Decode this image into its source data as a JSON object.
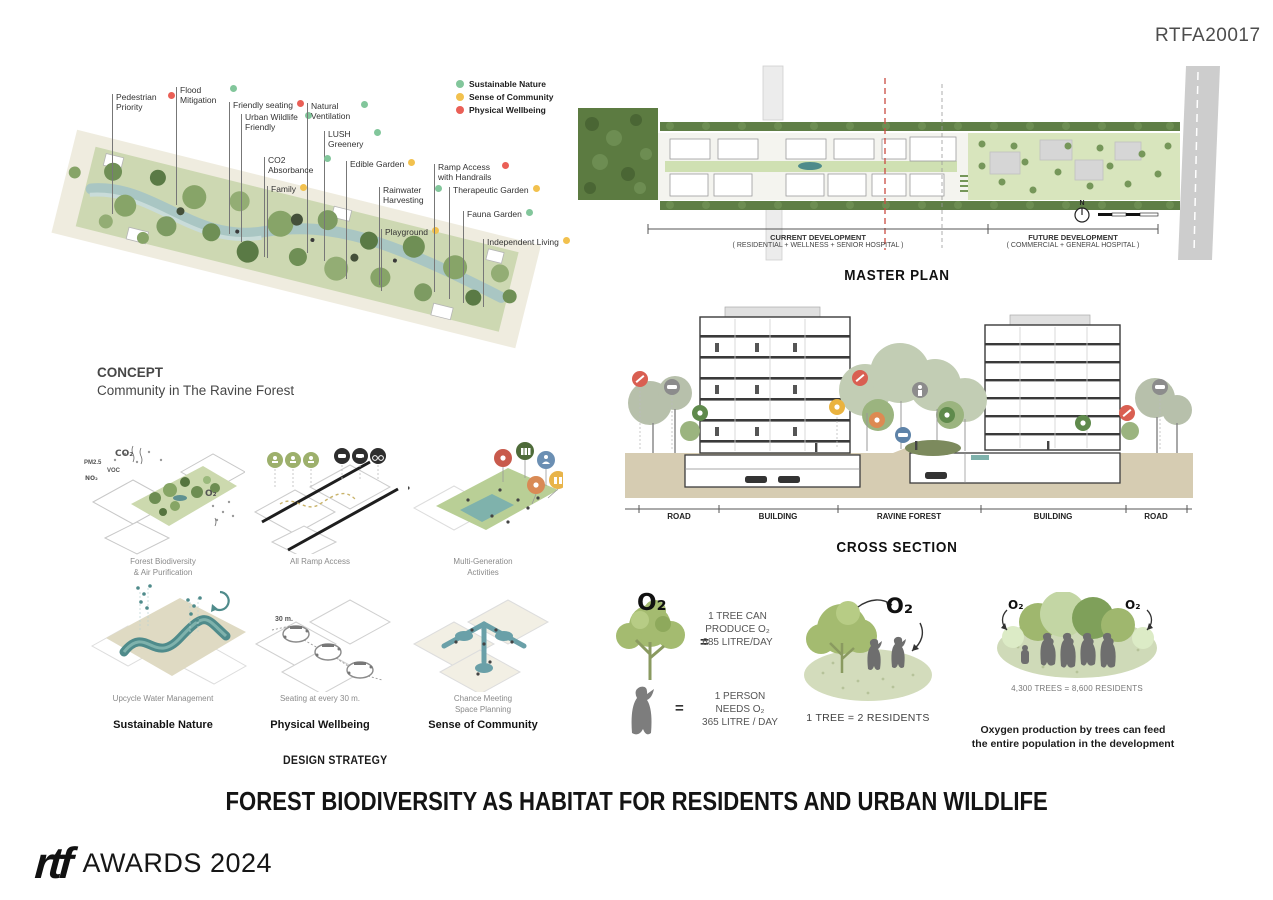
{
  "board": {
    "code": "RTFA20017",
    "main_title": "FOREST BIODIVERSITY AS HABITAT FOR RESIDENTS AND URBAN WILDLIFE",
    "footer_logo": "rtf",
    "footer_text": "AWARDS 2024"
  },
  "legend": {
    "items": [
      {
        "label": "Sustainable Nature",
        "color": "#82c69b"
      },
      {
        "label": "Sense of Community",
        "color": "#f2c14e"
      },
      {
        "label": "Physical Wellbeing",
        "color": "#ea5f56"
      }
    ]
  },
  "concept": {
    "title": "CONCEPT",
    "subtitle": "Community in The Ravine Forest",
    "callouts": [
      {
        "label": "Pedestrian Priority",
        "color": "#ea5f56"
      },
      {
        "label": "Flood Mitigation",
        "color": "#82c69b"
      },
      {
        "label": "Friendly seating",
        "color": "#ea5f56"
      },
      {
        "label": "Urban Wildlife Friendly",
        "color": "#82c69b"
      },
      {
        "label": "Natural Ventilation",
        "color": "#82c69b"
      },
      {
        "label": "LUSH Greenery",
        "color": "#82c69b"
      },
      {
        "label": "CO2 Absorbance",
        "color": "#82c69b"
      },
      {
        "label": "Family",
        "color": "#f2c14e"
      },
      {
        "label": "Edible Garden",
        "color": "#f2c14e"
      },
      {
        "label": "Rainwater Harvesting",
        "color": "#82c69b"
      },
      {
        "label": "Playground",
        "color": "#f2c14e"
      },
      {
        "label": "Ramp Access with Handrails",
        "color": "#ea5f56"
      },
      {
        "label": "Therapeutic Garden",
        "color": "#f2c14e"
      },
      {
        "label": "Fauna Garden",
        "color": "#82c69b"
      },
      {
        "label": "Independent Living",
        "color": "#f2c14e"
      }
    ]
  },
  "master_plan": {
    "title": "MASTER PLAN",
    "north_label": "N",
    "current": {
      "line1": "CURRENT DEVELOPMENT",
      "line2": "( RESIDENTIAL + WELLNESS + SENIOR HOSPITAL )"
    },
    "future": {
      "line1": "FUTURE DEVELOPMENT",
      "line2": "( COMMERCIAL + GENERAL HOSPITAL )"
    }
  },
  "cross_section": {
    "title": "CROSS SECTION",
    "segments": [
      "ROAD",
      "BUILDING",
      "RAVINE FOREST",
      "BUILDING",
      "ROAD"
    ]
  },
  "design_strategy": {
    "title": "DESIGN STRATEGY",
    "columns": [
      "Sustainable Nature",
      "Physical Wellbeing",
      "Sense of Community"
    ],
    "captions": [
      "Forest Biodiversity\n& Air Purification",
      "All Ramp Access",
      "Multi-Generation\nActivities",
      "Upcycle Water Management",
      "Seating at every 30 m.",
      "Chance Meeting\nSpace Planning"
    ],
    "annotations": {
      "co2": "CO₂",
      "pm25": "PM2.5",
      "voc": "VOC",
      "no2": "NO₂",
      "o2": "O₂",
      "thirty": "30 m."
    }
  },
  "oxygen": {
    "o2": "O₂",
    "equals": "=",
    "tree_fact": "1 TREE CAN\nPRODUCE O₂\n685 LITRE/DAY",
    "person_fact": "1  PERSON\nNEEDS O₂\n365 LITRE / DAY",
    "equation_tree": "1 TREE = 2 RESIDENTS",
    "equation_total": "4,300 TREES = 8,600  RESIDENTS",
    "conclusion": "Oxygen production by trees can feed\nthe entire population in the development"
  }
}
